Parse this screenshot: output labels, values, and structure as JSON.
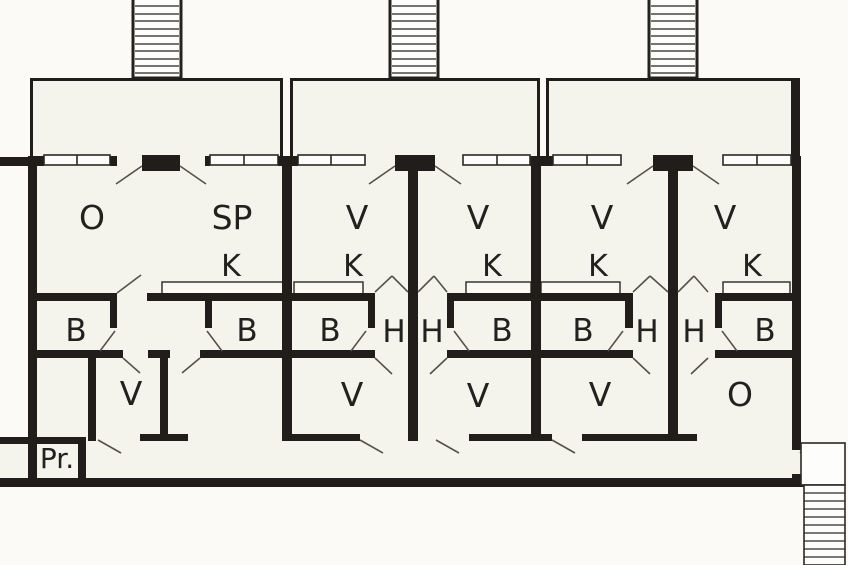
{
  "drawing": {
    "kind": "apartment-floor-plan",
    "colors": {
      "wall": "#201d1a",
      "paper": "#f5f4ec",
      "background": "#fbfaf7",
      "thin_line": "#555249",
      "fixture_outline": "#2b2925"
    }
  },
  "rooms": [
    {
      "name": "room-o-1",
      "label": "O"
    },
    {
      "name": "room-sp-1",
      "label": "SP"
    },
    {
      "name": "room-v-upper-2l",
      "label": "V"
    },
    {
      "name": "room-v-upper-2r",
      "label": "V"
    },
    {
      "name": "room-v-upper-3l",
      "label": "V"
    },
    {
      "name": "room-v-upper-3r",
      "label": "V"
    },
    {
      "name": "kitchen-1",
      "label": "K"
    },
    {
      "name": "kitchen-2l",
      "label": "K"
    },
    {
      "name": "kitchen-2r",
      "label": "K"
    },
    {
      "name": "kitchen-3l",
      "label": "K"
    },
    {
      "name": "kitchen-3r",
      "label": "K"
    },
    {
      "name": "room-b-1a",
      "label": "B"
    },
    {
      "name": "room-b-1b",
      "label": "B"
    },
    {
      "name": "room-b-2l",
      "label": "B"
    },
    {
      "name": "hall-h-2l",
      "label": "H"
    },
    {
      "name": "hall-h-2r",
      "label": "H"
    },
    {
      "name": "room-b-2r",
      "label": "B"
    },
    {
      "name": "room-b-3l",
      "label": "B"
    },
    {
      "name": "hall-h-3l",
      "label": "H"
    },
    {
      "name": "hall-h-3r",
      "label": "H"
    },
    {
      "name": "room-b-3r",
      "label": "B"
    },
    {
      "name": "room-v-lower-1",
      "label": "V"
    },
    {
      "name": "room-v-lower-2l",
      "label": "V"
    },
    {
      "name": "room-v-lower-2r",
      "label": "V"
    },
    {
      "name": "room-v-lower-3",
      "label": "V"
    },
    {
      "name": "room-o-3",
      "label": "O"
    },
    {
      "name": "room-pr",
      "label": "Pr."
    }
  ]
}
